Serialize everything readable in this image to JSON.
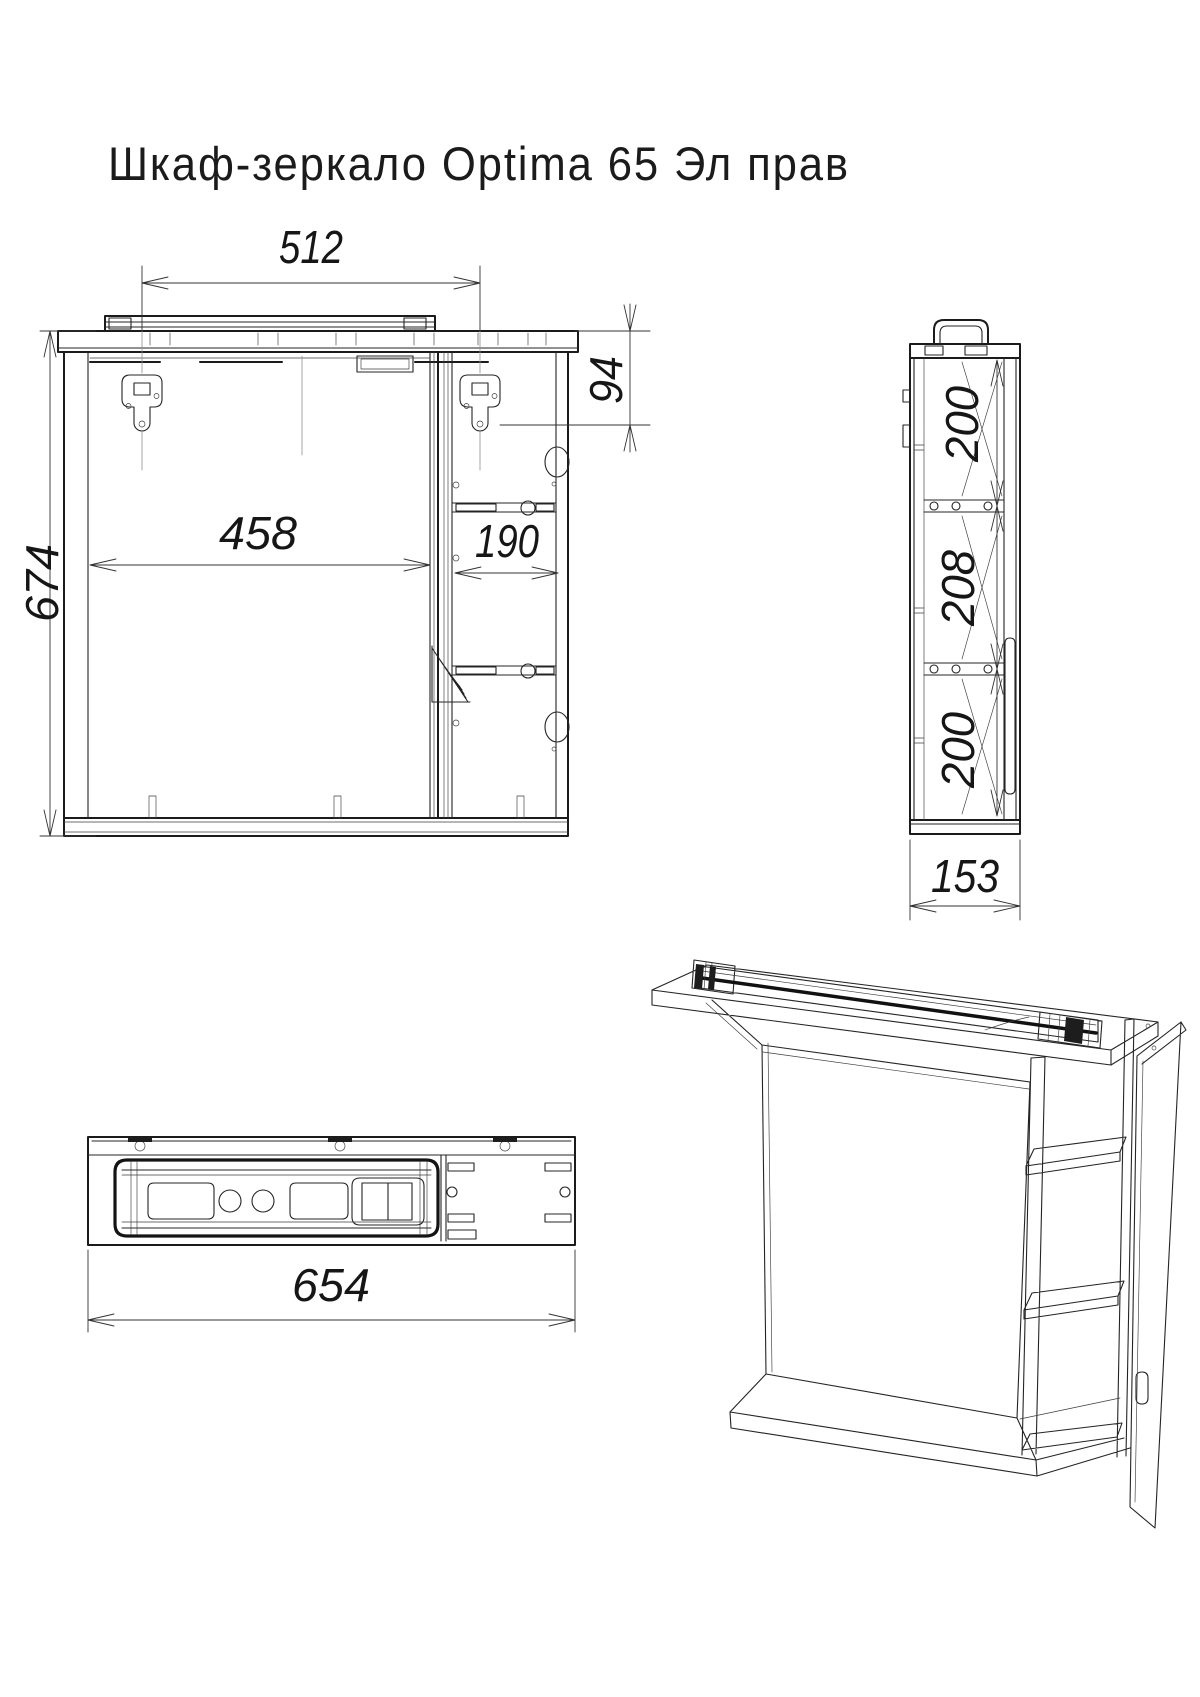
{
  "title": "Шкаф-зеркало Optima 65 Эл прав",
  "drawing": {
    "type": "furniture technical drawing",
    "product": "mirror cabinet",
    "views": [
      "front",
      "side",
      "bottom",
      "perspective"
    ]
  },
  "dimensions": {
    "mount_spacing_width": "512",
    "mount_top_offset": "94",
    "mirror_section_width": "458",
    "shelf_section_width": "190",
    "overall_height": "674",
    "side_top_section_height": "200",
    "side_middle_section_height": "208",
    "side_bottom_section_height": "200",
    "depth": "153",
    "overall_width": "654"
  },
  "colors": {
    "background": "#ffffff",
    "line": "#1b1b1b",
    "dim_line": "#333333"
  }
}
